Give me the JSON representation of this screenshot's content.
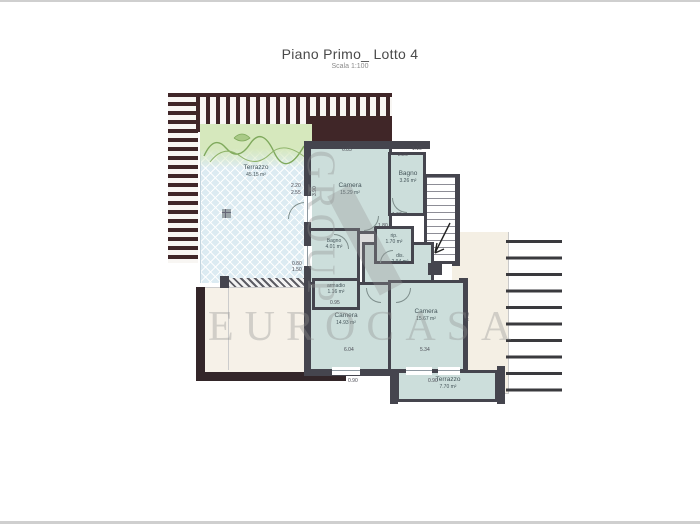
{
  "page": {
    "title": "Piano Primo_ Lotto 4",
    "subtitle": "Scala 1:100"
  },
  "watermark": {
    "vertical": "GROUP",
    "horizontal": "EUROCASA"
  },
  "rooms": [
    {
      "name": "Terrazzo",
      "area": "45.15 m²"
    },
    {
      "name": "Camera",
      "area": "15.29 m²"
    },
    {
      "name": "Bagno",
      "area": "3.26 m²"
    },
    {
      "name": "rip.",
      "area": "1.70 m²"
    },
    {
      "name": "dis.",
      "area": "2.94 m²"
    },
    {
      "name": "Bagno",
      "area": "4.01 m²"
    },
    {
      "name": "armadio",
      "area": "1.16 m²"
    },
    {
      "name": "Camera",
      "area": "14.93 m²"
    },
    {
      "name": "Camera",
      "area": "15.67 m²"
    },
    {
      "name": "Terrazzo",
      "area": "7.70 m²"
    }
  ],
  "dims": [
    "6.85",
    "3.90",
    "2.20",
    "2.55",
    "2.26",
    "1.60",
    "1.80",
    "0.80",
    "1.50",
    "0.95",
    "6.04",
    "5.34",
    "4.40",
    "1.10",
    "0.90",
    "0.90"
  ],
  "colors": {
    "wall": "#45454e",
    "pergola": "#402628",
    "room_fill": "#ccdedb",
    "terrace_tile": "#dcebf2",
    "cream": "#f4efe4",
    "greenery": "#d6e8bd",
    "dark_border": "#332629",
    "watermark": "#8f8f8f"
  }
}
